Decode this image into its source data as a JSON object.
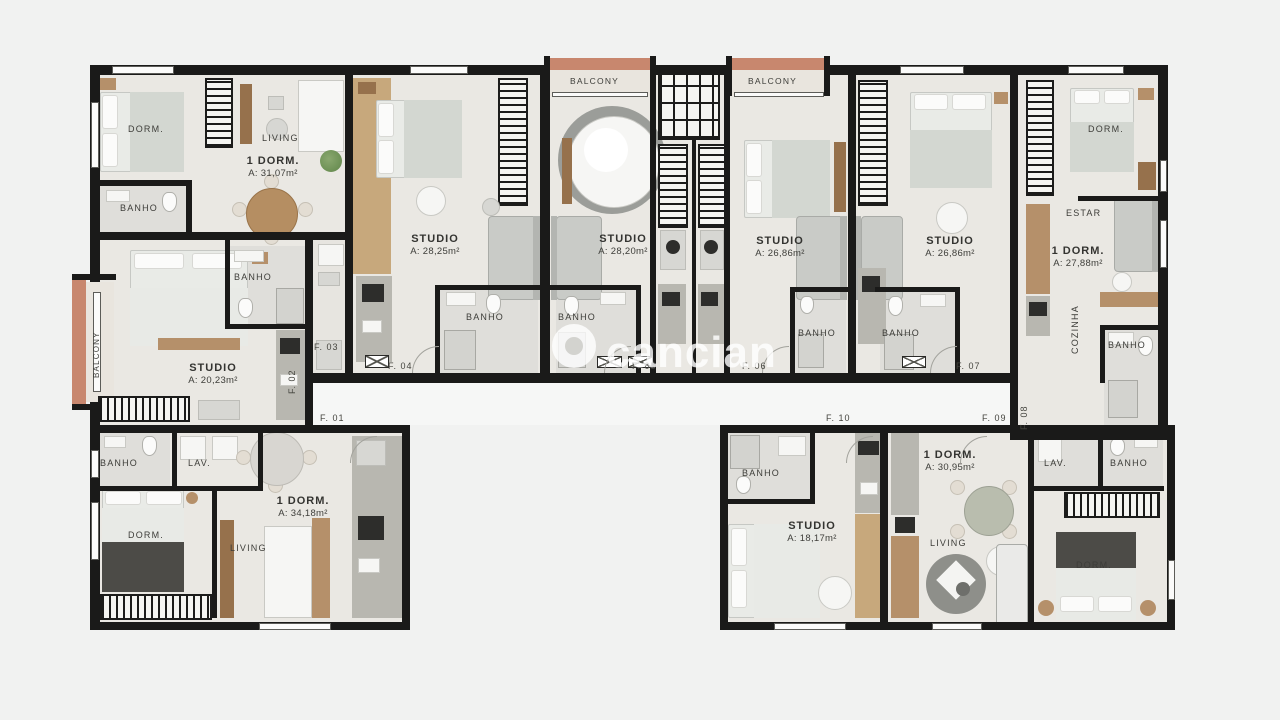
{
  "plan": {
    "watermark": "cancian",
    "balconies": {
      "left": "BALCONY",
      "top1": "BALCONY",
      "top2": "BALCONY"
    },
    "units": {
      "f01": {
        "door": "F. 01",
        "type": "1 DORM.",
        "area": "A: 34,18m²",
        "rooms": {
          "banho": "BANHO",
          "lav": "LAV.",
          "dorm": "DORM.",
          "living": "LIVING"
        }
      },
      "f02": {
        "door": "F. 02",
        "type": "STUDIO",
        "area": "A: 20,23m²",
        "rooms": {
          "banho": "BANHO"
        }
      },
      "f03": {
        "door": "F. 03",
        "type": "1 DORM.",
        "area": "A: 31,07m²",
        "rooms": {
          "dorm": "DORM.",
          "living": "LIVING",
          "banho": "BANHO"
        }
      },
      "f04": {
        "door": "F. 04",
        "type": "STUDIO",
        "area": "A: 28,25m²",
        "rooms": {
          "banho": "BANHO"
        }
      },
      "f05": {
        "door": "F. 05",
        "type": "STUDIO",
        "area": "A: 28,20m²",
        "rooms": {
          "banho": "BANHO"
        }
      },
      "f06": {
        "door": "F. 06",
        "type": "STUDIO",
        "area": "A: 26,86m²",
        "rooms": {
          "banho": "BANHO"
        }
      },
      "f07": {
        "door": "F. 07",
        "type": "STUDIO",
        "area": "A: 26,86m²",
        "rooms": {
          "banho": "BANHO"
        }
      },
      "f08": {
        "door": "F. 08",
        "type": "1 DORM.",
        "area": "A: 27,88m²",
        "rooms": {
          "dorm": "DORM.",
          "estar": "ESTAR",
          "cozinha": "COZINHA",
          "banho": "BANHO"
        }
      },
      "f09": {
        "door": "F. 09",
        "type": "1 DORM.",
        "area": "A: 30,95m²",
        "rooms": {
          "living": "LIVING",
          "lav": "LAV.",
          "banho": "BANHO",
          "dorm": "DORM."
        }
      },
      "f10": {
        "door": "F. 10",
        "type": "STUDIO",
        "area": "A: 18,17m²",
        "rooms": {
          "banho": "BANHO"
        }
      }
    },
    "colors": {
      "wall": "#1a1a19",
      "floor": "#eae8e3",
      "bath_floor": "#dfdeda",
      "balcony_rail": "#c8876e",
      "wood": "#b5906a",
      "background": "#f1f2f1"
    }
  }
}
